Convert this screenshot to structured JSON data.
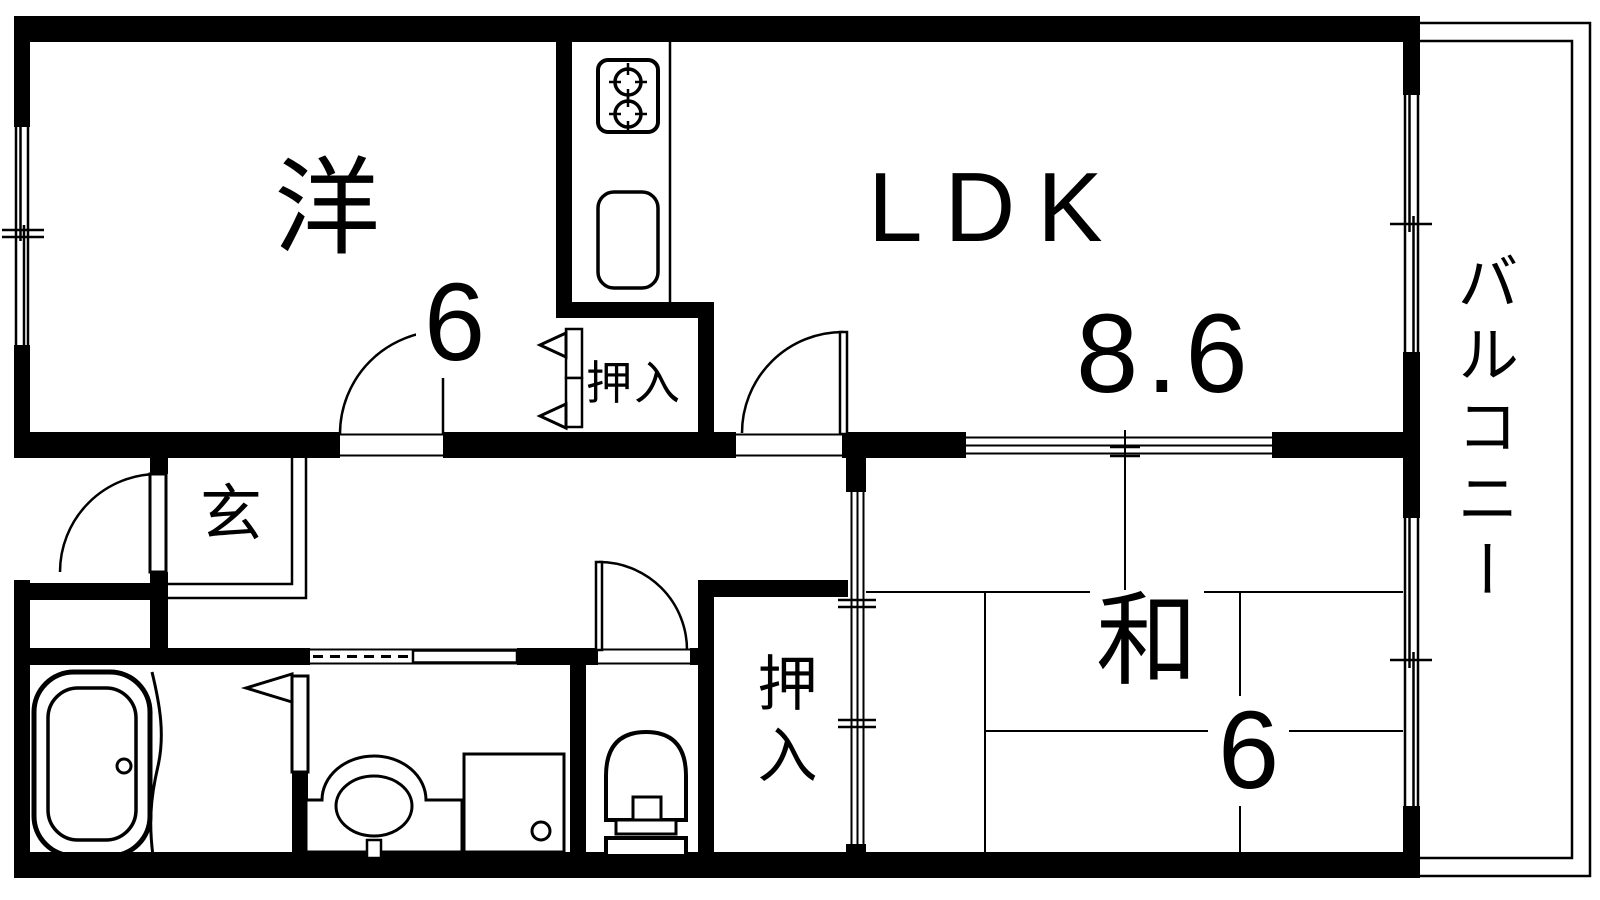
{
  "diagram_type": "apartment-floor-plan",
  "colors": {
    "line": "#000000",
    "background": "#ffffff"
  },
  "rooms": {
    "western": {
      "label": "洋",
      "size": "6"
    },
    "ldk": {
      "label": "LDK",
      "size": "8.6"
    },
    "japanese": {
      "label": "和",
      "size": "6"
    },
    "entrance": {
      "label": "玄"
    },
    "closet_upper": {
      "label": "押入"
    },
    "closet_lower": {
      "label": "押入"
    },
    "balcony": {
      "label": "バルコニー"
    }
  },
  "icons": {
    "stove": "gas-stove-2-burner-icon",
    "kitchen_sink": "kitchen-sink-icon",
    "bathtub": "bathtub-icon",
    "washbasin": "washbasin-icon",
    "washing_machine_pan": "washing-machine-pan-icon",
    "toilet": "toilet-icon",
    "hinged_door": "door-swing-arc-icon",
    "sliding_door": "sliding-door-track-icon",
    "window": "sliding-window-icon"
  }
}
